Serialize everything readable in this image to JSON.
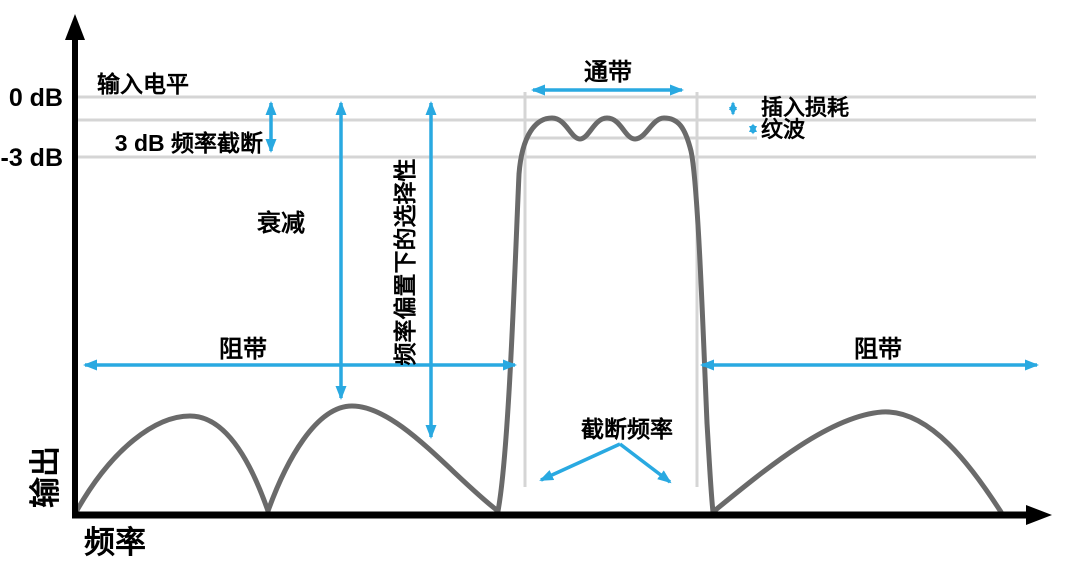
{
  "colors": {
    "accent": "#29A9E1",
    "curve": "#6A6A6A",
    "guide": "#D5D5D5",
    "axis": "#000000",
    "text": "#000000",
    "background": "#FFFFFF"
  },
  "axis": {
    "y_label": "输出",
    "x_label": "频率"
  },
  "ticks": {
    "zero_db": "0 dB",
    "minus_three_db": "-3 dB"
  },
  "annotations": {
    "input_level": "输入电平",
    "three_db_cutoff": "3 dB 频率截断",
    "attenuation": "衰减",
    "selectivity": "频率偏置下的选择性",
    "stopband_left": "阻带",
    "stopband_right": "阻带",
    "passband": "通带",
    "insertion_loss": "插入损耗",
    "ripple": "纹波",
    "cutoff_frequency": "截断频率"
  }
}
